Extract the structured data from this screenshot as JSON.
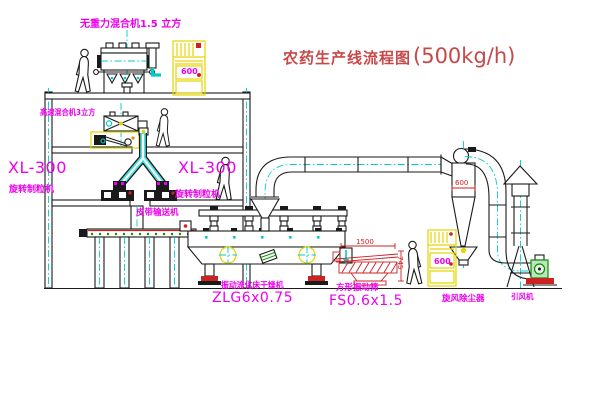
{
  "title": {
    "text": "农药生产线流程图",
    "capacity": "(500kg/h)"
  },
  "labels": {
    "gravity_mixer": "无重力混合机1.5 立方",
    "highspeed_mixer": "高速混合机3立方",
    "xl300_left_model": "XL-300",
    "xl300_left_name": "旋转制粒机",
    "xl300_right_model": "XL-300",
    "xl300_right_name": "旋转制粒机",
    "belt_conveyor": "皮带输送机",
    "dryer_name": "振动流化床干燥机",
    "dryer_model": "ZLG6x0.75",
    "screen_name": "方形振动筛",
    "screen_model": "FS0.6x1.5",
    "cyclone_name": "旋风除尘器",
    "fan_name": "引风机"
  },
  "dimensions": {
    "screen_length": "1500",
    "screen_height": "745",
    "cyclone_outlet": "600"
  },
  "cabinets": {
    "cabinet1_display": "600",
    "cabinet2_display": "600"
  },
  "colors": {
    "line": "#1a1a1a",
    "label": "#ee00ee",
    "title": "#c84848",
    "dimension": "#cc2222",
    "centerline": "#00cccc",
    "cabinet": "#e6d400",
    "chute": "#4fdede",
    "green": "#089000"
  }
}
